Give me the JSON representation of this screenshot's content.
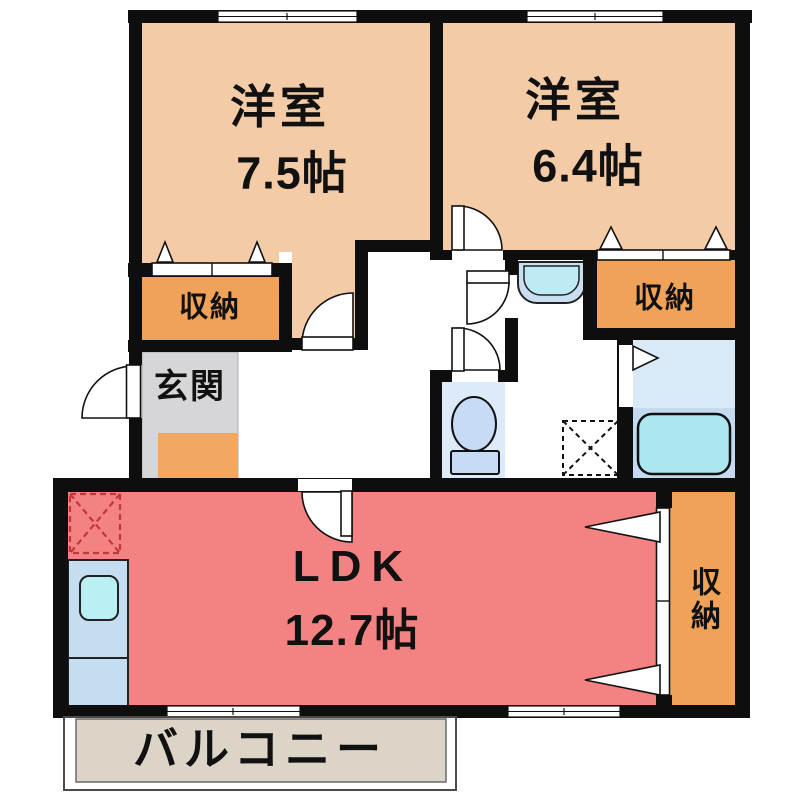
{
  "type": "apartment-floorplan",
  "labels": {
    "bedroom1_name": "洋室",
    "bedroom1_size": "7.5帖",
    "bedroom2_name": "洋室",
    "bedroom2_size": "6.4帖",
    "ldk_name": "LDK",
    "ldk_size": "12.7帖",
    "storage_left": "収納",
    "storage_right": "収納",
    "storage_ldk": "収納",
    "entrance": "玄関",
    "balcony": "バルコニー"
  },
  "colors": {
    "bedroom_floor": "#F3CBA6",
    "storage_floor": "#F0A259",
    "entrance_floor": "#D6D6D8",
    "entrance_mat": "#F1A862",
    "ldk_floor": "#F58282",
    "bath_floor_upper": "#D9E9F6",
    "bath_floor_lower": "#C5DAEE",
    "bathtub": "#ACE6F0",
    "toilet_room": "#DCEAF9",
    "fixture_blue": "#C7DCF4",
    "washbasin_bowl": "#BCEBF3",
    "kitchen_counter": "#C5DDF1",
    "kitchen_sink": "#B9F0F4",
    "balcony_floor": "#DCD4C7",
    "wall": "#0E0E0E",
    "fridge_dash": "#C03838"
  }
}
